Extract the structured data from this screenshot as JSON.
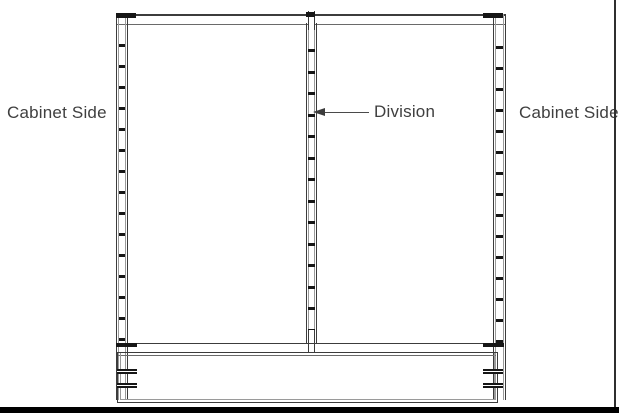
{
  "labels": {
    "cabinet_side_left": "Cabinet Side",
    "cabinet_side_right": "Cabinet Side",
    "division": "Division"
  },
  "colors": {
    "line": "#3c3c3c",
    "line_light": "#9a9a9a",
    "dark_mark": "#161616",
    "text": "#3f3f3f",
    "leader": "#4a4a4a",
    "footer_bar": "#000000",
    "border": "#2f2f2f",
    "background": "#ffffff"
  },
  "structure": {
    "hole_columns": [
      {
        "host": "left-side-panel",
        "name": "shelf-pin-hole",
        "start": 30,
        "step": 21,
        "count": 15,
        "inset": 2
      },
      {
        "host": "division-panel",
        "name": "shelf-pin-hole",
        "start": 26,
        "step": 21.5,
        "count": 14,
        "inset": 1
      },
      {
        "host": "right-side-panel",
        "name": "shelf-pin-hole",
        "start": 32,
        "step": 21,
        "count": 15,
        "inset": 2
      }
    ]
  }
}
